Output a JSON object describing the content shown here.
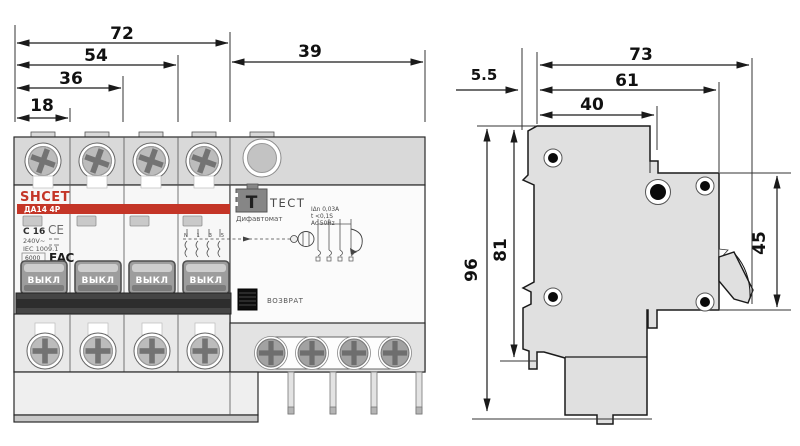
{
  "front_view": {
    "dims": {
      "w72": "72",
      "w54": "54",
      "w36": "36",
      "w18": "18",
      "w39": "39"
    },
    "breaker": {
      "brand": "SHCET",
      "model": "ДА14 4Р",
      "rating": "C 16",
      "voltage": "240V~",
      "standard": "IEC 1009.1",
      "breaking_capacity": "6000",
      "ce": "CE",
      "eac": "EAC",
      "toggle": "ВЫКЛ"
    },
    "rcd": {
      "test_button": "T",
      "test_label": "ТЕСТ",
      "device_type": "Дифавтомат",
      "spec1": "IΔn 0,03A",
      "spec2": "t <0,1S",
      "spec3": "Ac 50Hz",
      "reset": "ВОЗВРАТ",
      "pole_marks": "N 1 3 5"
    }
  },
  "side_view": {
    "dims": {
      "d73": "73",
      "d61": "61",
      "d40": "40",
      "d5_5": "5.5",
      "d96": "96",
      "d81": "81",
      "d45": "45"
    }
  },
  "colors": {
    "accent_red": "#c43527",
    "body_gray": "#e0e0e0",
    "handle_dark": "#3d3d3d"
  }
}
